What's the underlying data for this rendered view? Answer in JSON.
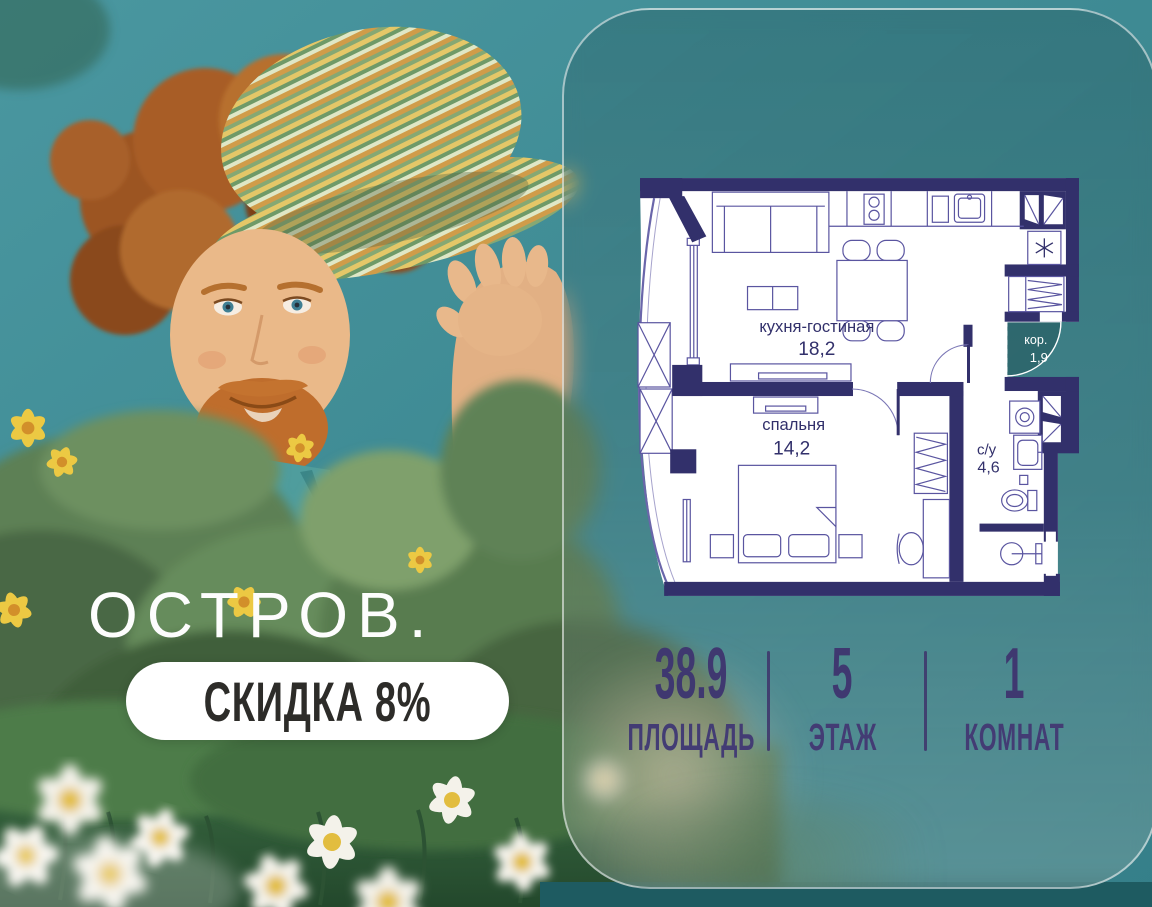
{
  "brand": {
    "name": "ОСТРОВ.",
    "discount_badge": "СКИДКА 8%"
  },
  "floor_plan": {
    "rooms": [
      {
        "name": "кухня-гостиная",
        "area": "18,2"
      },
      {
        "name": "спальня",
        "area": "14,2"
      },
      {
        "name": "с/у",
        "area": "4,6"
      },
      {
        "name": "кор.",
        "area": "1,9"
      }
    ]
  },
  "stats": [
    {
      "value": "38.9",
      "label": "ПЛОЩАДЬ"
    },
    {
      "value": "5",
      "label": "ЭТАЖ"
    },
    {
      "value": "1",
      "label": "КОМНАТ"
    }
  ],
  "colors": {
    "background_teal": "#3e8a93",
    "wall_navy": "#32306b",
    "stats_text": "#3f3870",
    "badge_text": "#2d2c29",
    "badge_background": "#ffffff"
  }
}
